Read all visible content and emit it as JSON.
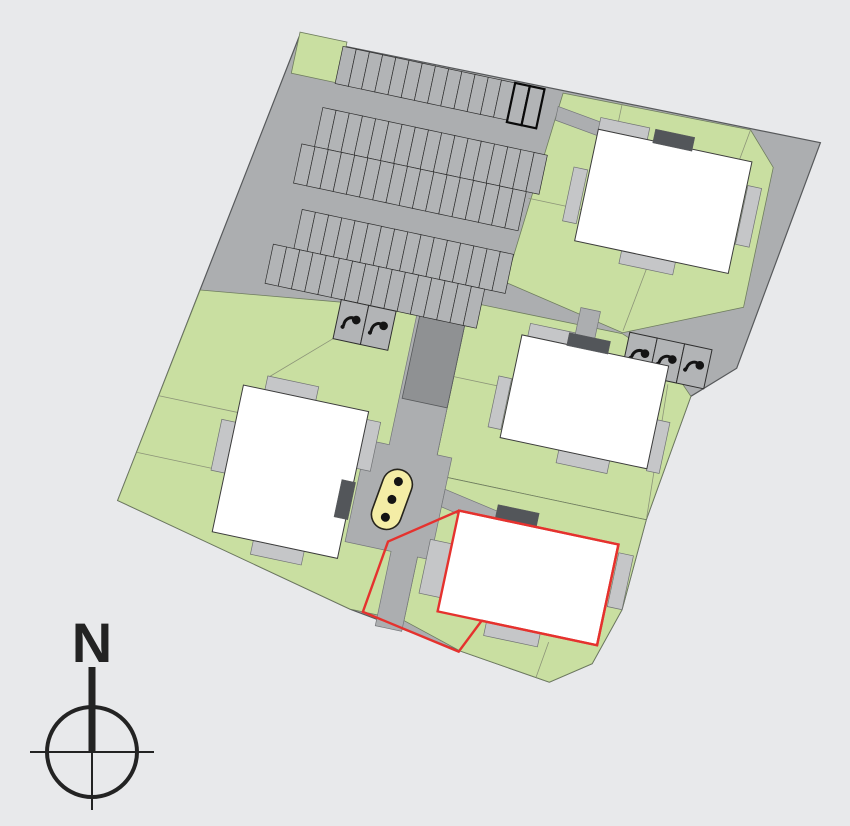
{
  "meta": {
    "canvas": {
      "w": 850,
      "h": 826
    },
    "bg": "#e8e9eb",
    "rotation_deg": 12,
    "pivot": {
      "x": 299,
      "y": 37
    },
    "colors": {
      "road": "#acaeb0",
      "road_stroke": "#74767a",
      "stall": "#b2b4b6",
      "stall_stroke": "#2e2e2e",
      "special_stall_stroke": "#0a0a0a",
      "green": "#c9dfa1",
      "green_stroke": "#6f7d5f",
      "parcel_line": "#8c9478",
      "shed": "#8f9193",
      "terrace": "#c5c6c8",
      "terrace_stroke": "#707274",
      "building": "#ffffff",
      "building_stroke": "#3c3c3c",
      "entry": "#53565a",
      "playground_fill": "#f4eda6",
      "playground_stroke": "#26241c",
      "selection_red": "#e5322e",
      "icon": "#141414",
      "site_stroke": "#57595b",
      "compass": "#232323"
    }
  },
  "site": {
    "outline": [
      [
        0,
        0
      ],
      [
        532,
        -5
      ],
      [
        497,
        233
      ],
      [
        458,
        270
      ],
      [
        440,
        400
      ],
      [
        435,
        493
      ],
      [
        417,
        552
      ],
      [
        379,
        579
      ],
      [
        285,
        567
      ],
      [
        169,
        549
      ],
      [
        -81,
        491
      ]
    ]
  },
  "greens": [
    {
      "name": "lawn-northwest-patch",
      "points": [
        [
          0,
          -5
        ],
        [
          48,
          -5
        ],
        [
          48,
          37
        ],
        [
          0,
          37
        ]
      ]
    },
    {
      "name": "lawn-block-northeast",
      "points": [
        [
          270,
          0
        ],
        [
          461,
          -3
        ],
        [
          491,
          29
        ],
        [
          491,
          172
        ],
        [
          378,
          222
        ],
        [
          253,
          197
        ]
      ]
    },
    {
      "name": "lawn-block-east",
      "points": [
        [
          222,
          224
        ],
        [
          378,
          223
        ],
        [
          430,
          243
        ],
        [
          458,
          270
        ],
        [
          440,
          400
        ],
        [
          222,
          400
        ]
      ]
    },
    {
      "name": "lawn-block-southeast",
      "points": [
        [
          224,
          400
        ],
        [
          440,
          400
        ],
        [
          435,
          493
        ],
        [
          417,
          552
        ],
        [
          379,
          579
        ],
        [
          285,
          567
        ],
        [
          224,
          549
        ]
      ]
    },
    {
      "name": "lawn-block-west",
      "points": [
        [
          -44,
          268
        ],
        [
          222,
          235
        ],
        [
          222,
          549
        ],
        [
          169,
          549
        ],
        [
          -81,
          491
        ]
      ]
    }
  ],
  "parcel_lines": [
    [
      330,
      -2,
      330,
      26
    ],
    [
      390,
      142,
      378,
      220
    ],
    [
      258,
      110,
      312,
      110
    ],
    [
      461,
      -3,
      452,
      58
    ],
    [
      222,
      300,
      280,
      300
    ],
    [
      433,
      263,
      440,
      398
    ],
    [
      370,
      540,
      365,
      577
    ],
    [
      -63,
      380,
      18,
      380
    ],
    [
      -72,
      440,
      4,
      440
    ],
    [
      96,
      288,
      40,
      340
    ]
  ],
  "roads": [
    {
      "name": "central-road",
      "points": [
        [
          173,
          228
        ],
        [
          222,
          224
        ],
        [
          222,
          380
        ],
        [
          237,
          380
        ],
        [
          237,
          484
        ],
        [
          224,
          484
        ],
        [
          224,
          560
        ],
        [
          197,
          560
        ],
        [
          197,
          484
        ],
        [
          150,
          484
        ],
        [
          150,
          380
        ],
        [
          173,
          380
        ]
      ]
    },
    {
      "name": "road-branch-southeast",
      "points": [
        [
          237,
          412
        ],
        [
          300,
          424
        ],
        [
          300,
          442
        ],
        [
          237,
          430
        ]
      ]
    },
    {
      "name": "path-northeast",
      "points": [
        [
          268,
          14
        ],
        [
          378,
          30
        ],
        [
          378,
          44
        ],
        [
          268,
          28
        ]
      ]
    },
    {
      "name": "path-east",
      "points": [
        [
          332,
          206
        ],
        [
          352,
          206
        ],
        [
          352,
          236
        ],
        [
          332,
          236
        ]
      ]
    }
  ],
  "shed": {
    "x": 176,
    "y": 214,
    "w": 46,
    "h": 118
  },
  "parking": {
    "rows": [
      {
        "x": 45,
        "y": 0,
        "count": 13,
        "w": 13.5,
        "h": 38,
        "special": false
      },
      {
        "x": 221,
        "y": 0,
        "count": 2,
        "w": 15,
        "h": 40,
        "special": true
      },
      {
        "x": 38,
        "y": 64,
        "count": 17,
        "w": 13.5,
        "h": 40,
        "special": false
      },
      {
        "x": 25,
        "y": 104,
        "count": 17,
        "w": 13.5,
        "h": 40,
        "special": false
      },
      {
        "x": 39,
        "y": 168,
        "count": 16,
        "w": 13.5,
        "h": 40,
        "special": false
      },
      {
        "x": 18,
        "y": 208,
        "count": 16,
        "w": 13.5,
        "h": 40,
        "special": false
      }
    ]
  },
  "moped_bays": [
    {
      "name": "moped-bays-west",
      "x": 96,
      "y": 248,
      "count": 2,
      "w": 28,
      "h": 40,
      "icon_rotate": 20
    },
    {
      "name": "moped-bays-east",
      "x": 385,
      "y": 220,
      "count": 3,
      "w": 28,
      "h": 40,
      "icon_rotate": 30
    }
  ],
  "buildings": [
    {
      "id": "building-1",
      "x": 312,
      "y": 28,
      "w": 157,
      "h": 114,
      "selected": false,
      "terraces": [
        [
          312,
          16,
          50,
          12
        ],
        [
          296,
          70,
          14,
          55
        ],
        [
          470,
          52,
          14,
          60
        ],
        [
          360,
          142,
          55,
          13
        ]
      ],
      "entry": [
        368,
        16,
        40,
        14
      ]
    },
    {
      "id": "building-2",
      "x": 280,
      "y": 245,
      "w": 150,
      "h": 105,
      "selected": false,
      "terraces": [
        [
          286,
          232,
          46,
          13
        ],
        [
          266,
          290,
          13,
          52
        ],
        [
          430,
          300,
          13,
          52
        ],
        [
          340,
          350,
          52,
          13
        ]
      ],
      "entry": [
        326,
        233,
        42,
        13
      ]
    },
    {
      "id": "building-3",
      "x": 18,
      "y": 352,
      "w": 128,
      "h": 150,
      "selected": false,
      "terraces": [
        [
          40,
          338,
          52,
          14
        ],
        [
          4,
          390,
          14,
          52
        ],
        [
          146,
          360,
          14,
          50
        ],
        [
          60,
          502,
          52,
          14
        ]
      ],
      "entry": [
        134,
        424,
        14,
        38
      ]
    },
    {
      "id": "building-4",
      "x": 255,
      "y": 430,
      "w": 163,
      "h": 103,
      "selected": true,
      "terraces": [
        [
          233,
          464,
          22,
          55
        ],
        [
          420,
          438,
          15,
          55
        ],
        [
          305,
          533,
          55,
          14
        ]
      ],
      "entry": [
        292,
        416,
        42,
        14
      ]
    }
  ],
  "selection": {
    "outline": [
      [
        192,
        475
      ],
      [
        255,
        430
      ],
      [
        418,
        430
      ],
      [
        418,
        533
      ],
      [
        300,
        533
      ],
      [
        284,
        568
      ],
      [
        182,
        549
      ]
    ]
  },
  "playground": {
    "cx": 187,
    "cy": 433,
    "w": 30,
    "h": 62,
    "rotate": 8,
    "dot_offsets": [
      -19,
      0,
      19
    ],
    "dot_r": 4.5
  },
  "compass": {
    "label": "N",
    "cx": 92,
    "cy": 752,
    "r": 45,
    "h_half": 62,
    "thick_top": 85,
    "thin_bottom": 58,
    "label_y": 662,
    "font_size": 56
  }
}
